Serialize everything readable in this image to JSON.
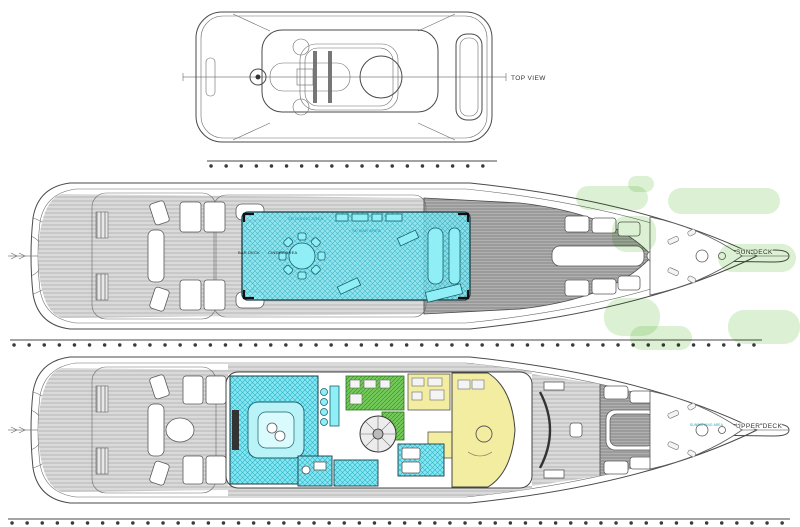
{
  "title": "Yacht deck plans",
  "top_view": {
    "label": "TOP VIEW"
  },
  "sun_deck": {
    "label": "SUN DECK",
    "dining_label": "SD DINING AREA",
    "bar_label": "SD BAR AREA",
    "deck_label": "BAR DECK",
    "cinema_label": "CINEMA AREA"
  },
  "upper_deck": {
    "label": "UPPER DECK",
    "sunbathing_label": "SUNBATHING AREA"
  },
  "colors": {
    "highlight_cyan": "#7EE4EF",
    "highlight_green": "#6FC653",
    "highlight_yellow": "#F2EDA0",
    "watermark_green": "#DCF1D4",
    "deck_gray": "#D8D8D8",
    "line_gray": "#4A4A4A"
  }
}
